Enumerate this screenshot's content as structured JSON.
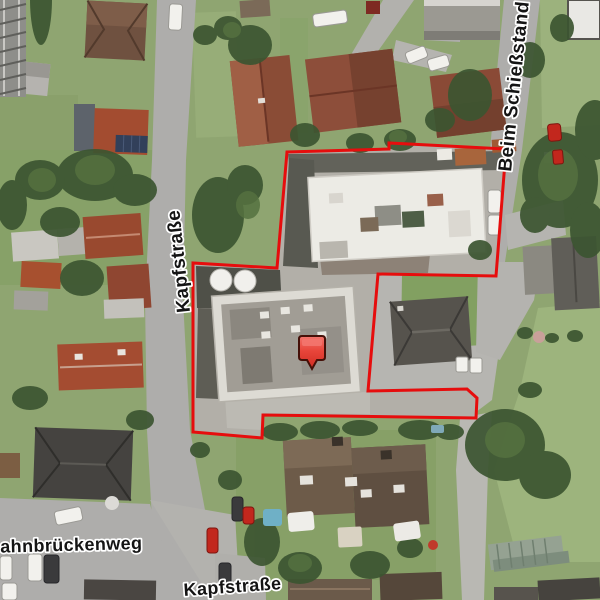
{
  "map": {
    "kind": "aerial-orthophoto",
    "labels": {
      "kapf_left": {
        "text": "Kapfstraße",
        "transform": "translate(190,312) rotate(-96)"
      },
      "beim": {
        "text": "Beim Schießstand",
        "transform": "translate(511,172) rotate(-84)"
      },
      "bahn": {
        "text": "Bahnbrückenweg",
        "transform": "translate(-13,553) rotate(-1.5)"
      },
      "kapf_bottom": {
        "text": "Kapfstraße",
        "transform": "translate(184,596) rotate(-4)"
      }
    },
    "boundary": {
      "color": "#e60d0d",
      "stroke_width": "3",
      "points": "287,152 389,149 389,143 506,149 496,276 378,274 368,391 467,389 477,398 476,418 263,415 262,438 193,432 193,263 277,268"
    },
    "marker": {
      "transform": "translate(299,336)",
      "fill_top": "#f3766e",
      "fill_mid": "#e8453a",
      "fill_bottom": "#d02c22",
      "outline": "#451008"
    },
    "palette": {
      "street_gray": "#aeadab",
      "ground_rubble": "#b2afa8",
      "lawn_green": "#8fa571",
      "tree_green": "#3c5531",
      "roof_red": "#8d4e3a",
      "roof_dark": "#56534d",
      "white_building": "#ecebe5"
    }
  }
}
